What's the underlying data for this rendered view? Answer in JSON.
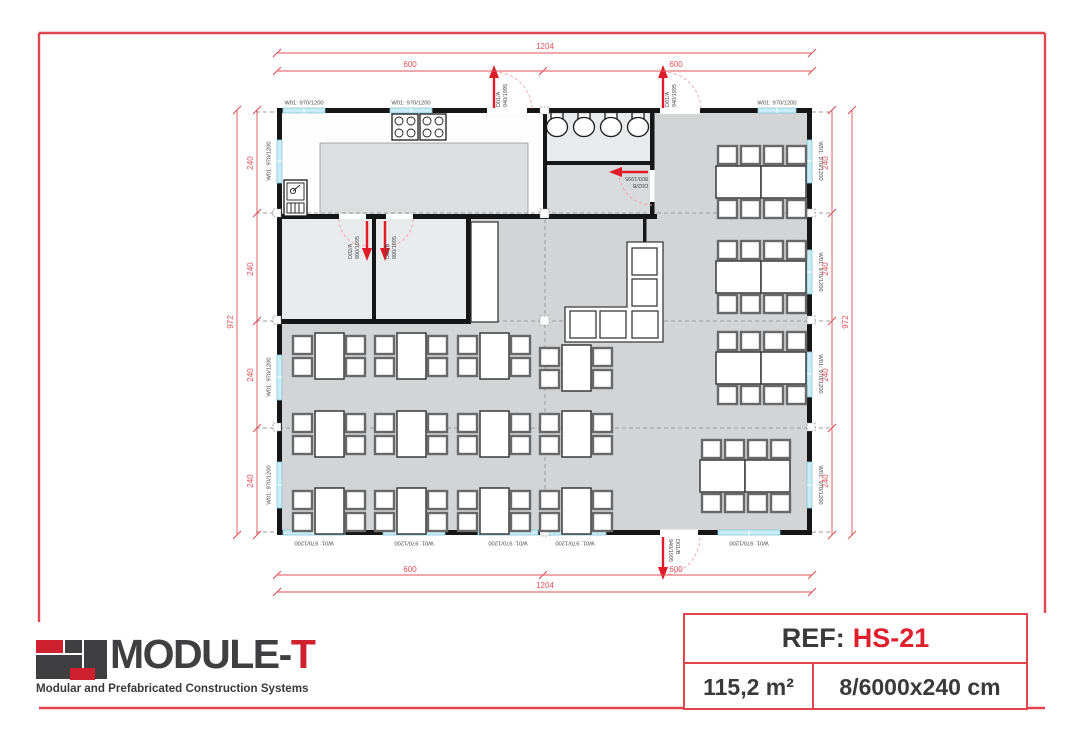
{
  "plan": {
    "dims": {
      "total_width": "1204",
      "half_width": "600",
      "total_height": "972",
      "module_height": "240"
    },
    "window_label": "W01: 970/1200",
    "doors": {
      "d01a": {
        "code": "D01/A",
        "size": "940/1995"
      },
      "d01b": {
        "code": "D01/B",
        "size": "940/1995"
      },
      "d02a": {
        "code": "D02/A",
        "size": "800/1995"
      },
      "d02b": {
        "code": "D02/B",
        "size": "800/1995"
      }
    }
  },
  "footer": {
    "brand_main": "MODULE-",
    "brand_accent": "T",
    "tagline": "Modular and Prefabricated Construction Systems",
    "ref_label": "REF:",
    "ref_value": "HS-21",
    "area": "115,2 m²",
    "module_spec": "8/6000x240 cm"
  },
  "colors": {
    "accent_red": "#e01f2d",
    "dim_red": "#e05058",
    "wall_black": "#161616",
    "window_cyan": "#c9ecf6"
  }
}
